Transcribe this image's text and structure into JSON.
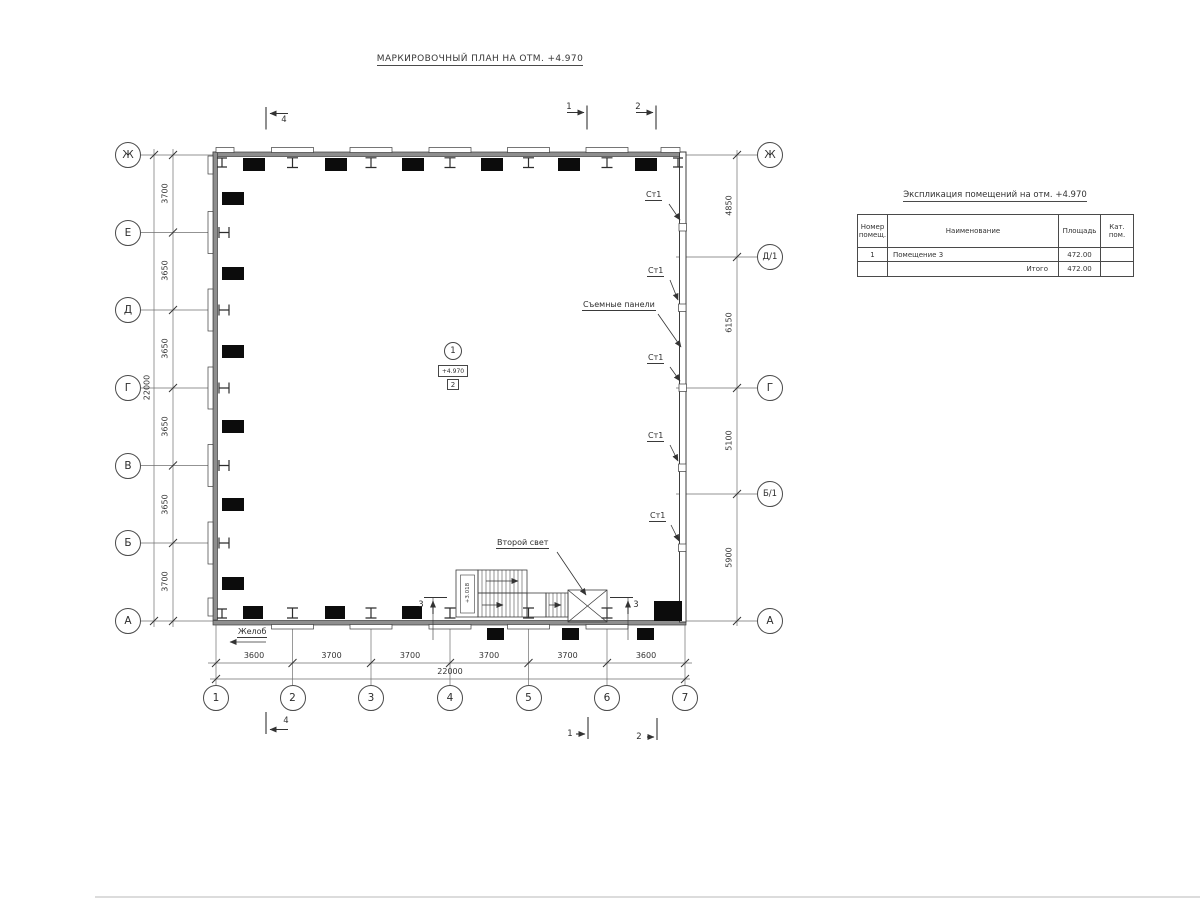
{
  "title": "МАРКИРОВОЧНЫЙ ПЛАН НА ОТМ. +4.970",
  "plan": {
    "axes_left": [
      "Ж",
      "Е",
      "Д",
      "Г",
      "В",
      "Б",
      "А"
    ],
    "axes_right": [
      "Ж",
      "Д/1",
      "Г",
      "Б/1",
      "А"
    ],
    "axes_bottom": [
      "1",
      "2",
      "3",
      "4",
      "5",
      "6",
      "7"
    ],
    "dims_left": [
      "3700",
      "3650",
      "3650",
      "3650",
      "3650",
      "3700"
    ],
    "dims_left_total": "22000",
    "dims_right": [
      "4850",
      "6150",
      "5100",
      "5900"
    ],
    "dims_bottom": [
      "3600",
      "3700",
      "3700",
      "3700",
      "3700",
      "3600"
    ],
    "dims_bottom_total": "22000",
    "labels": {
      "st1": "Ст1",
      "removable_panels": "Съемные панели",
      "second_light": "Второй свет",
      "gutter": "Желоб",
      "stair_landing_elevation": "+3.018"
    },
    "room_marker": {
      "number": "1",
      "elevation": "+4.970",
      "type_mark": "2"
    },
    "section_marks": {
      "s1": "1",
      "s2": "2",
      "s3": "3",
      "s4": "4"
    }
  },
  "table": {
    "title": "Экспликация помещений на отм. +4.970",
    "headers": {
      "number_l1": "Номер",
      "number_l2": "помещ.",
      "name": "Наименование",
      "area": "Площадь",
      "category_l1": "Кат.",
      "category_l2": "пом."
    },
    "rows": [
      {
        "number": "1",
        "name": "Помещение 3",
        "area": "472.00",
        "category": ""
      }
    ],
    "total_label": "Итого",
    "total_area": "472.00"
  },
  "colors": {
    "line": "#3c3c3c",
    "wall_fill": "#8e8e8e",
    "black_fill": "#0c0c0c",
    "background": "#ffffff"
  }
}
